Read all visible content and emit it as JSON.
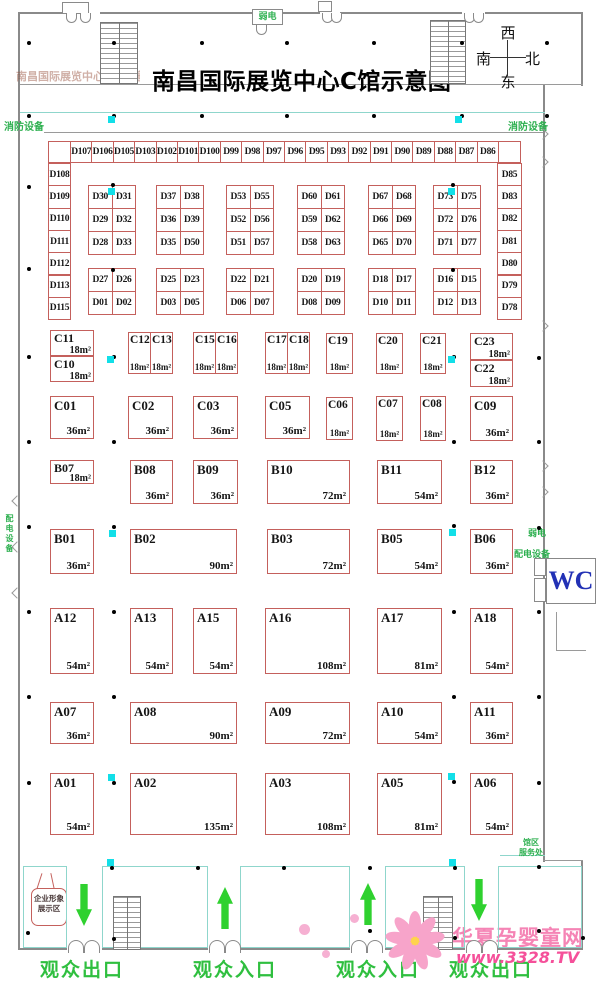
{
  "title": "南昌国际展览中心C馆示意图",
  "faint_title": "南昌国际展览中心C馆示意图",
  "compass": {
    "top": "西",
    "left": "南",
    "right": "北",
    "bottom": "东"
  },
  "labels": {
    "fire_equipment_left": "消防设备",
    "fire_equipment_right": "消防设备",
    "weak_current_top": "弱电",
    "weak_current_right": "弱电",
    "power_equipment_right": "配电设备",
    "power_equipment_left": "配电设备",
    "wc": "WC",
    "service_desk_line1": "馆区",
    "service_desk_line2": "服务处",
    "corporate_image_line1": "企业形象",
    "corporate_image_line2": "展示区",
    "exit_left": "观众出口",
    "entrance_left": "观众入口",
    "entrance_right": "观众入口",
    "exit_right": "观众出口"
  },
  "watermark": {
    "site_name": "华夏孕婴童网",
    "site_url": "www.3328.TV"
  },
  "colors": {
    "booth_border": "#c4605c",
    "green": "#2eb050",
    "arrow_green": "#2fd12f",
    "teal": "#8fd6cc",
    "cyan_marker": "#12dfe8",
    "wc_blue": "#2231b5",
    "watermark_pink": "#f584b5",
    "watermark_url_pink": "#f5509a"
  },
  "d_zone": {
    "top_row": [
      "D107",
      "D106",
      "D105",
      "D103",
      "D102",
      "D101",
      "D100",
      "D99",
      "D98",
      "D97",
      "D96",
      "D95",
      "D93",
      "D92",
      "D91",
      "D90",
      "D89",
      "D88",
      "D87",
      "D86"
    ],
    "left_col": [
      "D108",
      "D109",
      "D110",
      "D111",
      "D112",
      "D113",
      "D115"
    ],
    "right_col": [
      "D85",
      "D83",
      "D82",
      "D81",
      "D80",
      "D79",
      "D78"
    ],
    "upper_blocks": [
      [
        "D30",
        "D31",
        "D29",
        "D32",
        "D28",
        "D33"
      ],
      [
        "D37",
        "D38",
        "D36",
        "D39",
        "D35",
        "D50"
      ],
      [
        "D53",
        "D55",
        "D52",
        "D56",
        "D51",
        "D57"
      ],
      [
        "D60",
        "D61",
        "D59",
        "D62",
        "D58",
        "D63"
      ],
      [
        "D67",
        "D68",
        "D66",
        "D69",
        "D65",
        "D70"
      ],
      [
        "D73",
        "D75",
        "D72",
        "D76",
        "D71",
        "D77"
      ]
    ],
    "lower_blocks": [
      [
        "D27",
        "D26",
        "D01",
        "D02"
      ],
      [
        "D25",
        "D23",
        "D03",
        "D05"
      ],
      [
        "D22",
        "D21",
        "D06",
        "D07"
      ],
      [
        "D20",
        "D19",
        "D08",
        "D09"
      ],
      [
        "D18",
        "D17",
        "D10",
        "D11"
      ],
      [
        "D16",
        "D15",
        "D12",
        "D13"
      ]
    ]
  },
  "booths": [
    {
      "id": "C11",
      "area": "18m²",
      "x": 50,
      "y": 330,
      "w": 44,
      "h": 26,
      "s": "half"
    },
    {
      "id": "C10",
      "area": "18m²",
      "x": 50,
      "y": 356,
      "w": 44,
      "h": 26,
      "s": "half"
    },
    {
      "id": "C12",
      "area": "18m²",
      "x": 128,
      "y": 332,
      "w": 23,
      "h": 42,
      "s": "narrow"
    },
    {
      "id": "C13",
      "area": "18m²",
      "x": 150,
      "y": 332,
      "w": 23,
      "h": 42,
      "s": "narrow"
    },
    {
      "id": "C15",
      "area": "18m²",
      "x": 193,
      "y": 332,
      "w": 23,
      "h": 42,
      "s": "narrow"
    },
    {
      "id": "C16",
      "area": "18m²",
      "x": 215,
      "y": 332,
      "w": 23,
      "h": 42,
      "s": "narrow"
    },
    {
      "id": "C17",
      "area": "18m²",
      "x": 265,
      "y": 332,
      "w": 23,
      "h": 42,
      "s": "narrow"
    },
    {
      "id": "C18",
      "area": "18m²",
      "x": 287,
      "y": 332,
      "w": 23,
      "h": 42,
      "s": "narrow"
    },
    {
      "id": "C19",
      "area": "18m²",
      "x": 326,
      "y": 333,
      "w": 27,
      "h": 41,
      "s": "narrow"
    },
    {
      "id": "C20",
      "area": "18m²",
      "x": 376,
      "y": 333,
      "w": 27,
      "h": 41,
      "s": "narrow"
    },
    {
      "id": "C21",
      "area": "18m²",
      "x": 420,
      "y": 333,
      "w": 26,
      "h": 41,
      "s": "narrow"
    },
    {
      "id": "C23",
      "area": "18m²",
      "x": 470,
      "y": 333,
      "w": 43,
      "h": 27,
      "s": "half"
    },
    {
      "id": "C22",
      "area": "18m²",
      "x": 470,
      "y": 360,
      "w": 43,
      "h": 27,
      "s": "half"
    },
    {
      "id": "C01",
      "area": "36m²",
      "x": 50,
      "y": 396,
      "w": 44,
      "h": 43
    },
    {
      "id": "C02",
      "area": "36m²",
      "x": 128,
      "y": 396,
      "w": 45,
      "h": 43
    },
    {
      "id": "C03",
      "area": "36m²",
      "x": 193,
      "y": 396,
      "w": 45,
      "h": 43
    },
    {
      "id": "C05",
      "area": "36m²",
      "x": 265,
      "y": 396,
      "w": 45,
      "h": 43
    },
    {
      "id": "C06",
      "area": "18m²",
      "x": 326,
      "y": 397,
      "w": 27,
      "h": 43,
      "s": "narrow"
    },
    {
      "id": "C07",
      "area": "18m²",
      "x": 376,
      "y": 396,
      "w": 27,
      "h": 45,
      "s": "narrow"
    },
    {
      "id": "C08",
      "area": "18m²",
      "x": 420,
      "y": 396,
      "w": 26,
      "h": 45,
      "s": "narrow"
    },
    {
      "id": "C09",
      "area": "36m²",
      "x": 470,
      "y": 396,
      "w": 43,
      "h": 45
    },
    {
      "id": "B07",
      "area": "18m²",
      "x": 50,
      "y": 460,
      "w": 44,
      "h": 24,
      "s": "half"
    },
    {
      "id": "B08",
      "area": "36m²",
      "x": 130,
      "y": 460,
      "w": 43,
      "h": 44
    },
    {
      "id": "B09",
      "area": "36m²",
      "x": 193,
      "y": 460,
      "w": 45,
      "h": 44
    },
    {
      "id": "B10",
      "area": "72m²",
      "x": 267,
      "y": 460,
      "w": 83,
      "h": 44
    },
    {
      "id": "B11",
      "area": "54m²",
      "x": 377,
      "y": 460,
      "w": 65,
      "h": 44
    },
    {
      "id": "B12",
      "area": "36m²",
      "x": 470,
      "y": 460,
      "w": 43,
      "h": 44
    },
    {
      "id": "B01",
      "area": "36m²",
      "x": 50,
      "y": 529,
      "w": 44,
      "h": 45
    },
    {
      "id": "B02",
      "area": "90m²",
      "x": 130,
      "y": 529,
      "w": 107,
      "h": 45
    },
    {
      "id": "B03",
      "area": "72m²",
      "x": 267,
      "y": 529,
      "w": 83,
      "h": 45
    },
    {
      "id": "B05",
      "area": "54m²",
      "x": 377,
      "y": 529,
      "w": 65,
      "h": 45
    },
    {
      "id": "B06",
      "area": "36m²",
      "x": 470,
      "y": 529,
      "w": 43,
      "h": 45
    },
    {
      "id": "A12",
      "area": "54m²",
      "x": 50,
      "y": 608,
      "w": 44,
      "h": 66
    },
    {
      "id": "A13",
      "area": "54m²",
      "x": 130,
      "y": 608,
      "w": 43,
      "h": 66
    },
    {
      "id": "A15",
      "area": "54m²",
      "x": 193,
      "y": 608,
      "w": 44,
      "h": 66
    },
    {
      "id": "A16",
      "area": "108m²",
      "x": 265,
      "y": 608,
      "w": 85,
      "h": 66
    },
    {
      "id": "A17",
      "area": "81m²",
      "x": 377,
      "y": 608,
      "w": 65,
      "h": 66
    },
    {
      "id": "A18",
      "area": "54m²",
      "x": 470,
      "y": 608,
      "w": 43,
      "h": 66
    },
    {
      "id": "A07",
      "area": "36m²",
      "x": 50,
      "y": 702,
      "w": 44,
      "h": 42
    },
    {
      "id": "A08",
      "area": "90m²",
      "x": 130,
      "y": 702,
      "w": 107,
      "h": 42
    },
    {
      "id": "A09",
      "area": "72m²",
      "x": 265,
      "y": 702,
      "w": 85,
      "h": 42
    },
    {
      "id": "A10",
      "area": "54m²",
      "x": 377,
      "y": 702,
      "w": 65,
      "h": 42
    },
    {
      "id": "A11",
      "area": "36m²",
      "x": 470,
      "y": 702,
      "w": 43,
      "h": 42
    },
    {
      "id": "A01",
      "area": "54m²",
      "x": 50,
      "y": 773,
      "w": 44,
      "h": 62
    },
    {
      "id": "A02",
      "area": "135m²",
      "x": 130,
      "y": 773,
      "w": 107,
      "h": 62
    },
    {
      "id": "A03",
      "area": "108m²",
      "x": 265,
      "y": 773,
      "w": 85,
      "h": 62
    },
    {
      "id": "A05",
      "area": "81m²",
      "x": 377,
      "y": 773,
      "w": 65,
      "h": 62
    },
    {
      "id": "A06",
      "area": "54m²",
      "x": 470,
      "y": 773,
      "w": 43,
      "h": 62
    }
  ],
  "arrows": [
    {
      "x": 76,
      "y": 884,
      "dir": "down"
    },
    {
      "x": 217,
      "y": 887,
      "dir": "up"
    },
    {
      "x": 360,
      "y": 883,
      "dir": "up"
    },
    {
      "x": 471,
      "y": 879,
      "dir": "down"
    }
  ],
  "plan_marks": {
    "pillars": [
      [
        27,
        41
      ],
      [
        112,
        41
      ],
      [
        200,
        41
      ],
      [
        285,
        41
      ],
      [
        372,
        41
      ],
      [
        460,
        41
      ],
      [
        545,
        41
      ],
      [
        27,
        114
      ],
      [
        112,
        114
      ],
      [
        200,
        114
      ],
      [
        285,
        114
      ],
      [
        372,
        114
      ],
      [
        460,
        114
      ],
      [
        545,
        114
      ],
      [
        27,
        185
      ],
      [
        111,
        183
      ],
      [
        451,
        183
      ],
      [
        27,
        267
      ],
      [
        111,
        268
      ],
      [
        451,
        268
      ],
      [
        27,
        355
      ],
      [
        112,
        355
      ],
      [
        452,
        355
      ],
      [
        537,
        356
      ],
      [
        27,
        440
      ],
      [
        112,
        440
      ],
      [
        452,
        440
      ],
      [
        537,
        440
      ],
      [
        27,
        525
      ],
      [
        112,
        525
      ],
      [
        452,
        524
      ],
      [
        537,
        526
      ],
      [
        27,
        610
      ],
      [
        112,
        610
      ],
      [
        452,
        610
      ],
      [
        537,
        610
      ],
      [
        27,
        695
      ],
      [
        112,
        695
      ],
      [
        452,
        695
      ],
      [
        537,
        695
      ],
      [
        27,
        781
      ],
      [
        112,
        781
      ],
      [
        452,
        780
      ],
      [
        537,
        781
      ],
      [
        110,
        866
      ],
      [
        196,
        866
      ],
      [
        282,
        866
      ],
      [
        368,
        866
      ],
      [
        453,
        866
      ],
      [
        537,
        865
      ],
      [
        26,
        931
      ],
      [
        112,
        937
      ],
      [
        368,
        929
      ],
      [
        453,
        936
      ],
      [
        537,
        929
      ],
      [
        581,
        936
      ]
    ],
    "cyan": [
      [
        108,
        116
      ],
      [
        455,
        116
      ],
      [
        108,
        188
      ],
      [
        448,
        188
      ],
      [
        107,
        356
      ],
      [
        448,
        356
      ],
      [
        109,
        530
      ],
      [
        449,
        529
      ],
      [
        108,
        774
      ],
      [
        448,
        773
      ],
      [
        107,
        859
      ],
      [
        449,
        859
      ]
    ]
  },
  "layout": {
    "d_top": {
      "x": 70,
      "y": 141,
      "cw": 21.4,
      "ch": 22
    },
    "d_left": {
      "x": 48,
      "y": 163,
      "cw": 22,
      "ch": 22.3
    },
    "d_right": {
      "x": 497,
      "y": 163,
      "cw": 24,
      "ch": 22.3
    },
    "blocks_x": [
      88,
      156,
      226,
      297,
      368,
      433
    ],
    "cell_w": 23.5,
    "cell_h": 23,
    "upper_y": 185,
    "lower_y": 268,
    "bays": [
      [
        23,
        44
      ],
      [
        102,
        106
      ],
      [
        240,
        110
      ],
      [
        385,
        80
      ],
      [
        498,
        84
      ]
    ],
    "bottom_doors": [
      68,
      209,
      351,
      466
    ],
    "top_doors": [
      [
        66,
        13
      ],
      [
        80,
        13
      ],
      [
        322,
        13
      ],
      [
        331,
        13
      ],
      [
        464,
        13
      ],
      [
        473,
        13
      ],
      [
        256,
        25
      ]
    ],
    "stairs": [
      [
        100,
        22,
        38,
        62
      ],
      [
        430,
        20,
        36,
        64
      ],
      [
        113,
        896,
        28,
        54
      ],
      [
        423,
        896,
        30,
        54
      ]
    ],
    "vents": [
      [
        62,
        2,
        27,
        12
      ],
      [
        318,
        1,
        14,
        11
      ]
    ],
    "masks": [
      [
        64,
        11,
        36,
        4
      ],
      [
        320,
        10,
        20,
        4
      ],
      [
        462,
        10,
        23,
        4
      ],
      [
        67,
        946,
        35,
        6
      ],
      [
        208,
        946,
        32,
        6
      ],
      [
        350,
        946,
        35,
        6
      ],
      [
        465,
        946,
        33,
        6
      ]
    ],
    "chev_right": [
      130,
      158,
      322,
      462,
      488
    ],
    "chev_left": [
      497,
      543,
      589
    ]
  }
}
